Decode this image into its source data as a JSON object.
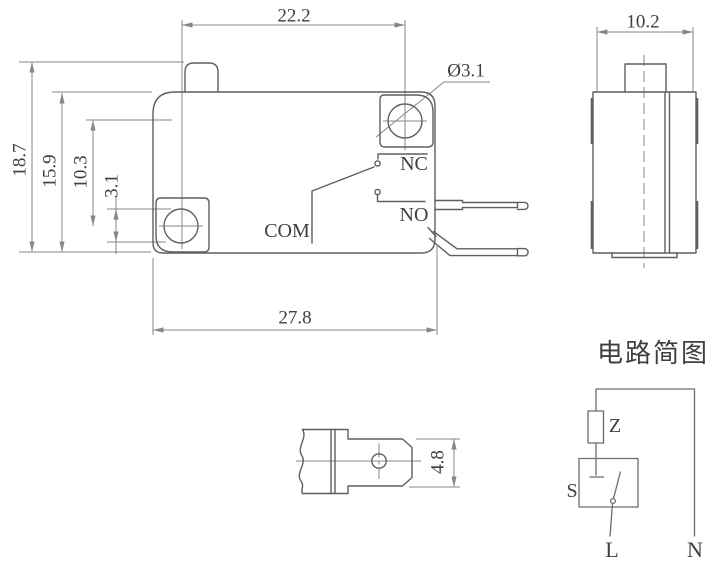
{
  "drawing": {
    "front_view": {
      "dim_hole_spacing": "22.2",
      "dim_overall_height": "18.7",
      "dim_body_height": "15.9",
      "dim_hole_height": "10.3",
      "dim_hole_span": "3.1",
      "dim_hole_diameter": "Ø3.1",
      "dim_body_width": "27.8",
      "label_nc": "NC",
      "label_no": "NO",
      "label_com": "COM"
    },
    "side_view": {
      "dim_width": "10.2"
    },
    "terminal_view": {
      "dim_height": "4.8"
    },
    "circuit": {
      "title": "电路简图",
      "label_z": "Z",
      "label_s": "S",
      "label_l": "L",
      "label_n": "N"
    },
    "colors": {
      "outline": "#5d5f61",
      "dimension": "#85878a",
      "text": "#3e4042"
    }
  }
}
